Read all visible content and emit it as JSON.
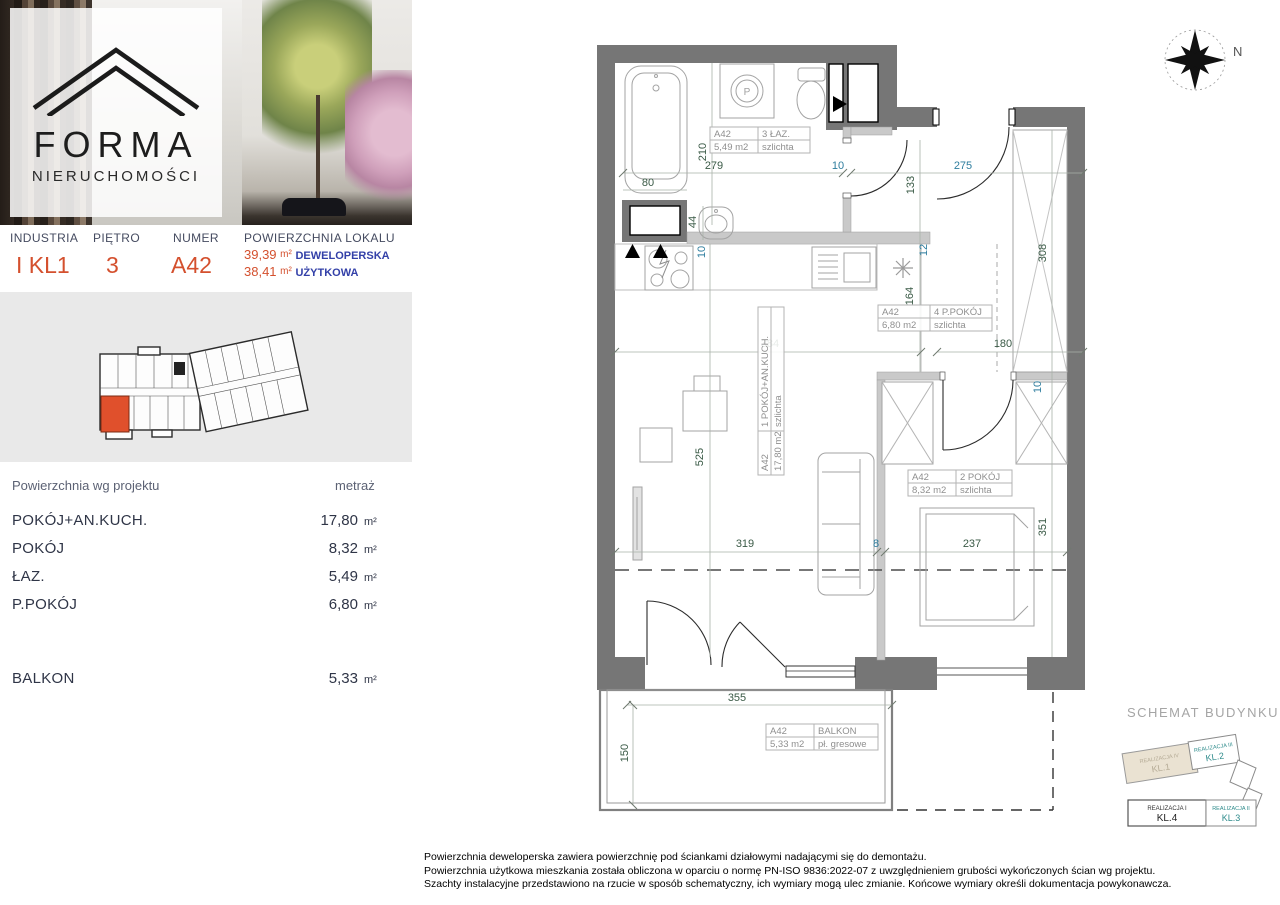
{
  "brand": {
    "name": "FORMA",
    "subtitle": "NIERUCHOMOŚCI"
  },
  "unit_header": {
    "investment_label": "INDUSTRIA",
    "investment_value": "I KL1",
    "floor_label": "PIĘTRO",
    "floor_value": "3",
    "number_label": "NUMER",
    "number_value": "A42",
    "area_label": "POWIERZCHNIA LOKALU",
    "area_developer": {
      "value": "39,39",
      "unit": "m²",
      "label": "DEWELOPERSKA"
    },
    "area_usable": {
      "value": "38,41",
      "unit": "m²",
      "label": "UŻYTKOWA"
    }
  },
  "area_table": {
    "col_room": "Powierzchnia wg projektu",
    "col_area": "metraż",
    "rows": [
      {
        "label": "POKÓJ+AN.KUCH.",
        "value": "17,80",
        "unit": "m²"
      },
      {
        "label": "POKÓJ",
        "value": "8,32",
        "unit": "m²"
      },
      {
        "label": "ŁAZ.",
        "value": "5,49",
        "unit": "m²"
      },
      {
        "label": "P.POKÓJ",
        "value": "6,80",
        "unit": "m²"
      }
    ],
    "balcony": {
      "label": "BALKON",
      "value": "5,33",
      "unit": "m²"
    }
  },
  "plan": {
    "compass": "N",
    "washer_symbol": "P",
    "labels": {
      "bath": {
        "code": "A42",
        "name": "3 ŁAZ.",
        "area": "5,49 m2",
        "finish": "szlichta"
      },
      "hall": {
        "code": "A42",
        "name": "4 P.POKÓJ",
        "area": "6,80 m2",
        "finish": "szlichta"
      },
      "living": {
        "code": "A42",
        "name": "1 POKÓJ+AN.KUCH.",
        "area": "17,80 m2",
        "finish": "szlichta"
      },
      "bedroom": {
        "code": "A42",
        "name": "2 POKÓJ",
        "area": "8,32 m2",
        "finish": "szlichta"
      },
      "balcony": {
        "code": "A42",
        "name": "BALKON",
        "area": "5,33 m2",
        "finish": "pł. gresowe"
      }
    },
    "dims": {
      "bath_width": "279",
      "wall_top": "10",
      "entry_width": "275",
      "bath_height": "210",
      "tub_width": "80",
      "basin": "44",
      "hall_depth": "133",
      "kitchen_wall": "10",
      "shaft": "12",
      "hall_height": "164",
      "living_width": "384",
      "hall_width": "180",
      "closet_height": "308",
      "living_height": "525",
      "table_line": "319",
      "sofa_gap": "8",
      "bed_width": "237",
      "bed_height": "351",
      "bedroom_wall": "10",
      "balcony_width": "355",
      "balcony_height": "150"
    }
  },
  "schematic": {
    "title": "SCHEMAT BUDYNKU",
    "segments": [
      {
        "name": "REALIZACJA IV",
        "stair": "KL.1",
        "current": true
      },
      {
        "name": "REALIZACJA III",
        "stair": "KL.2",
        "current": false
      },
      {
        "name": "REALIZACJA I",
        "stair": "KL.4",
        "current": false
      },
      {
        "name": "REALIZACJA II",
        "stair": "KL.3",
        "current": false
      }
    ]
  },
  "footer": {
    "lines": [
      "Powierzchnia deweloperska zawiera powierzchnię pod ściankami działowymi nadającymi się do demontażu.",
      "Powierzchnia użytkowa mieszkania została obliczona w oparciu o normę  PN-ISO 9836:2022-07 z uwzględnieniem grubości wykończonych ścian wg projektu.",
      "Szachty instalacyjne przedstawiono na rzucie w sposób schematyczny, ich wymiary mogą ulec zmianie. Końcowe wymiary określi dokumentacja powykonawcza."
    ]
  },
  "colors": {
    "accent": "#d4502e",
    "blue": "#3340a8",
    "dim_green": "#3a5a46",
    "dim_teal": "#2e7d9e",
    "wall": "#767676",
    "partition": "#c9c9c9",
    "unit_highlight": "#e0502c",
    "schemat_teal": "#2e8b8b"
  }
}
